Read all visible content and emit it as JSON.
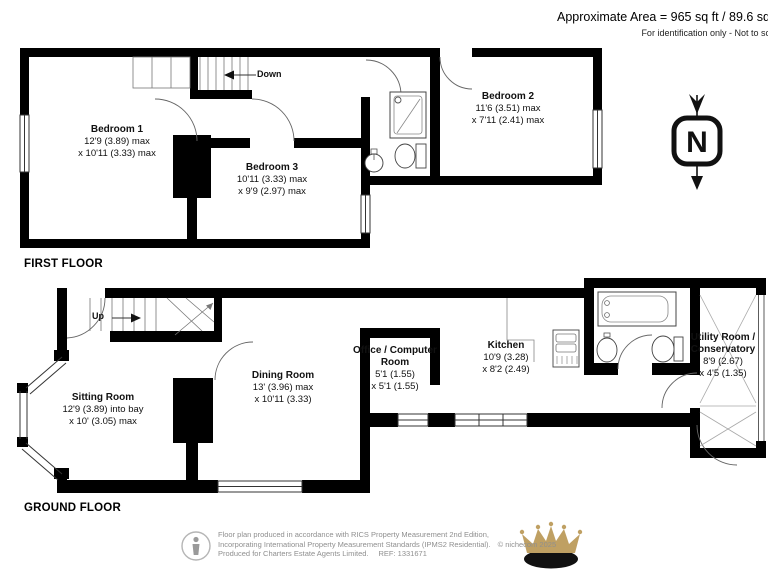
{
  "header": {
    "approx_area": "Approximate Area = 965 sq ft / 89.6 sq",
    "scale_note": "For identification only - Not to sc"
  },
  "first_floor": {
    "label": "FIRST FLOOR",
    "stairs_label": "Down",
    "rooms": [
      {
        "name": "Bedroom 1",
        "dim1": "12'9 (3.89) max",
        "dim2": "x 10'11 (3.33) max"
      },
      {
        "name": "Bedroom 3",
        "dim1": "10'11 (3.33) max",
        "dim2": "x 9'9 (2.97) max"
      },
      {
        "name": "Bedroom 2",
        "dim1": "11'6 (3.51) max",
        "dim2": "x 7'11 (2.41) max"
      }
    ]
  },
  "ground_floor": {
    "label": "GROUND FLOOR",
    "stairs_label": "Up",
    "rooms": [
      {
        "name": "Sitting Room",
        "dim1": "12'9 (3.89) into bay",
        "dim2": "x 10' (3.05) max"
      },
      {
        "name": "Dining Room",
        "dim1": "13' (3.96) max",
        "dim2": "x 10'11 (3.33)"
      },
      {
        "name": "Office / Computer Room",
        "dim1": "5'1 (1.55)",
        "dim2": "x 5'1 (1.55)"
      },
      {
        "name": "Kitchen",
        "dim1": "10'9 (3.28)",
        "dim2": "x 8'2 (2.49)"
      },
      {
        "name": "Utility Room / Conservatory",
        "dim1": "8'9 (2.67)",
        "dim2": "x 4'5 (1.35)"
      }
    ]
  },
  "compass": {
    "label": "N"
  },
  "footer": {
    "line1": "Floor plan produced in accordance with RICS Property Measurement 2nd Edition,",
    "line2": "Incorporating International Property Measurement Standards (IPMS2 Residential).",
    "copyright": "© nichecom 2025",
    "line3": "Produced for Charters Estate Agents Limited.",
    "ref": "REF: 1331671"
  },
  "icons": {
    "compass": "north-arrow-icon",
    "producer": "person-icon",
    "brand": "crown-logo"
  },
  "colors": {
    "wall": "#000000",
    "thin_line": "#555555",
    "glazing_line": "#9a9a9a",
    "crown_gold": "#bfa063",
    "footer_text": "#8f8f8f"
  }
}
